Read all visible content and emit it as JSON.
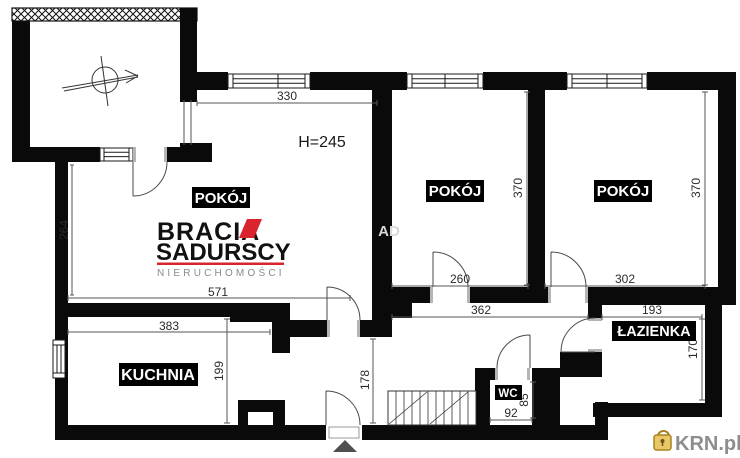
{
  "rooms": {
    "pokoj1": "POKÓJ",
    "pokoj2": "POKÓJ",
    "pokoj3": "POKÓJ",
    "kuchnia": "KUCHNIA",
    "lazienka": "ŁAZIENKA",
    "wc": "WC"
  },
  "notes": {
    "ceiling_height": "H=245"
  },
  "dims": {
    "room1_window": "330",
    "room1_left": "264",
    "room1_bottom": "571",
    "kitchen_top": "383",
    "kitchen_right": "199",
    "hall_left": "178",
    "room2_right": "370",
    "room3_right": "370",
    "room2_bottom": "260",
    "room3_bottom": "302",
    "hall_bottom": "362",
    "bath_top": "193",
    "bath_right": "170",
    "wc_bottom": "92",
    "wc_right": "85"
  },
  "branding": {
    "name_line1": "BRACIA",
    "name_line2": "SADURSCY",
    "tagline": "NIERUCHOMOŚCI",
    "watermark_fragment": "AD",
    "accent_color": "#d9232e",
    "tagline_color": "#8a8a8a"
  },
  "footer_logo": {
    "text": "KRN.pl",
    "text_color": "#8d8d8d",
    "lock_color": "#e9c767"
  },
  "colors": {
    "wall": "#0a0a0a",
    "dim_text": "#2b2b2b",
    "label_bg": "#000000",
    "label_text": "#ffffff",
    "entrance_marker": "#4f4f4f"
  }
}
